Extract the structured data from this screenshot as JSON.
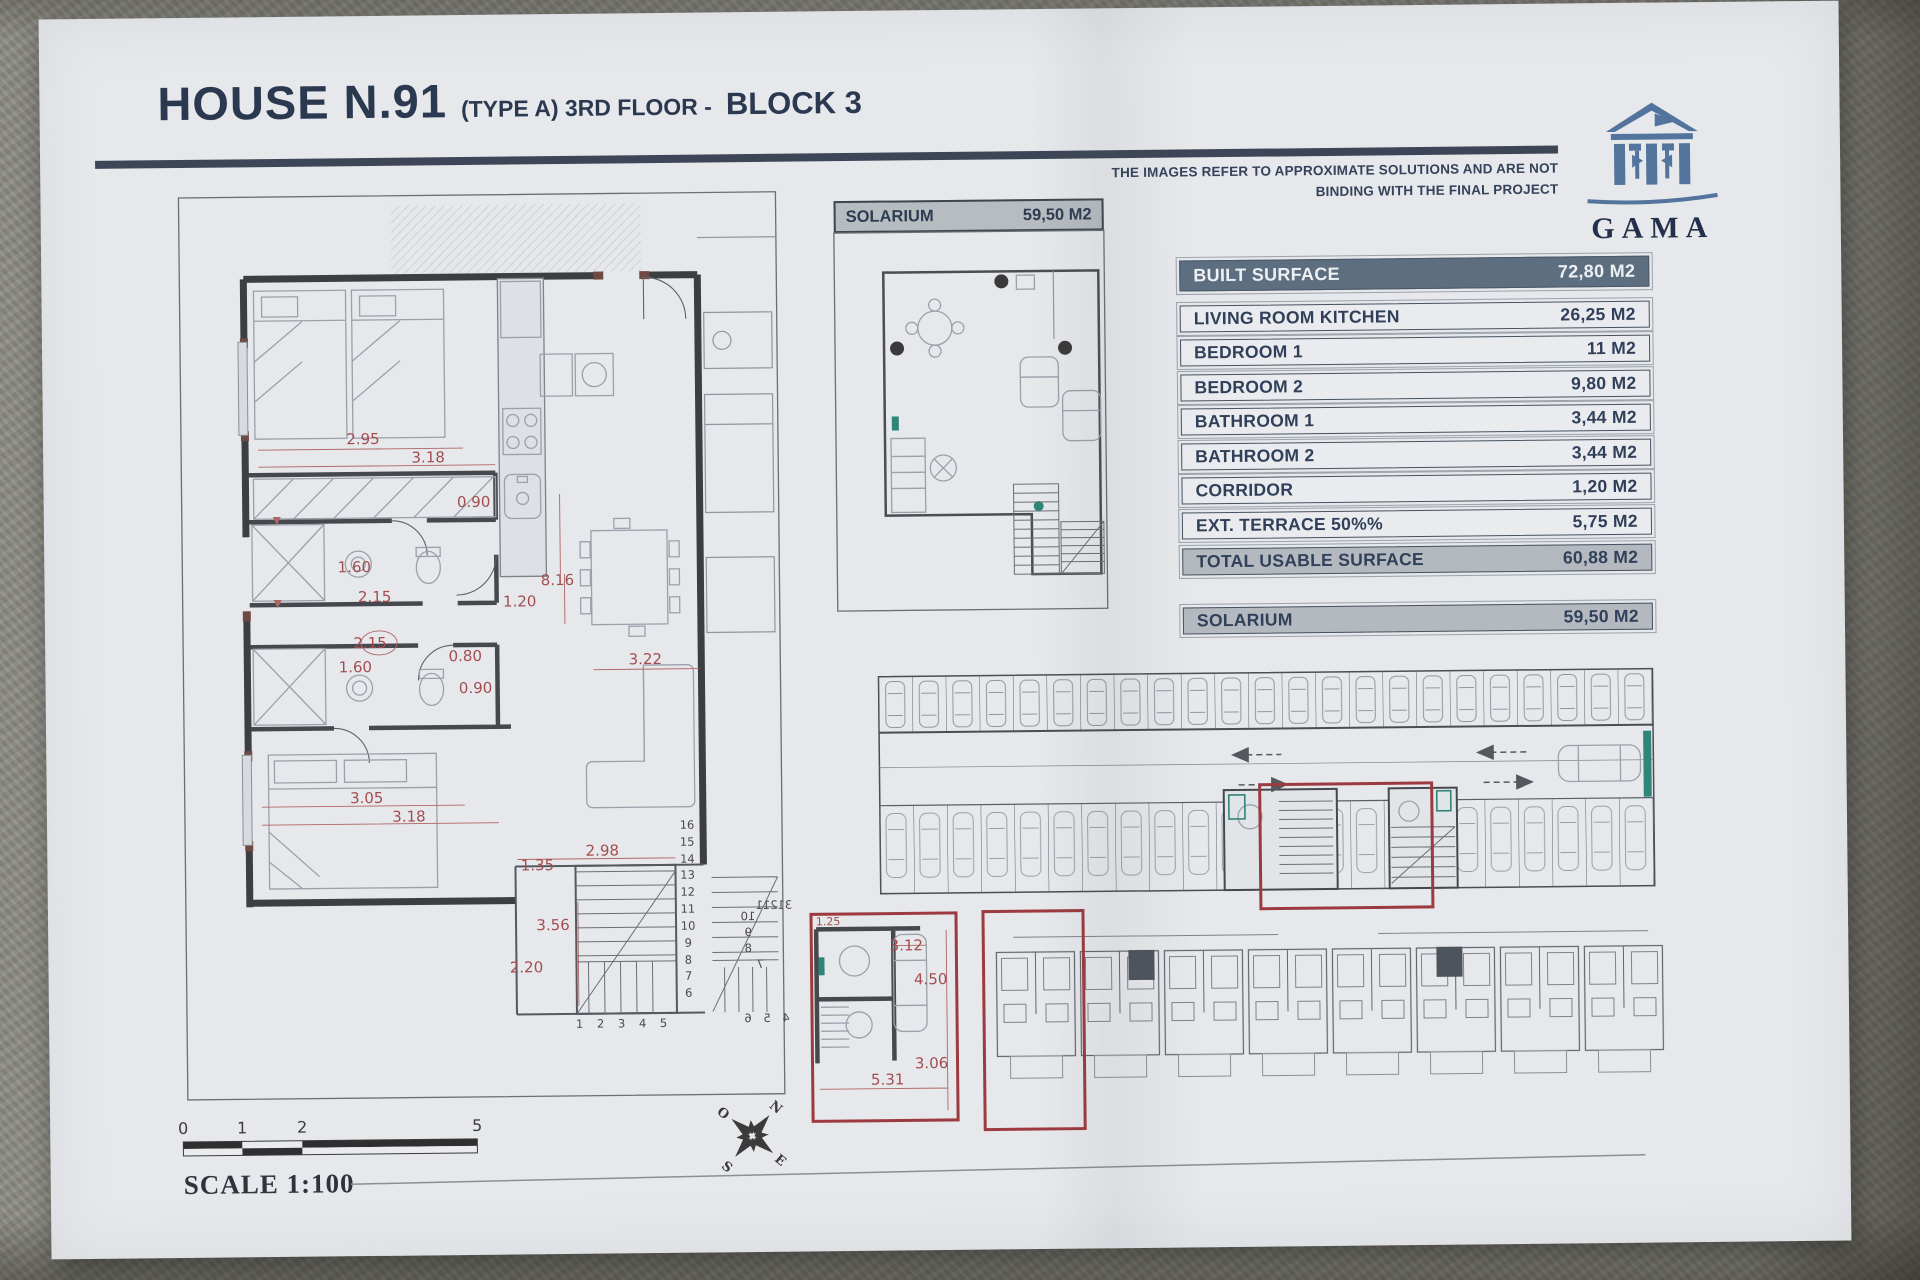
{
  "colors": {
    "accent_navy": "#31405a",
    "table_header_bg": "#5d6e80",
    "highlight_red": "#9c3a40",
    "dimension_red": "#a34d4f",
    "logo_blue": "#53749c",
    "teal_accent": "#2f8577",
    "paper": "#e6e8eb"
  },
  "header": {
    "title": "HOUSE N.91",
    "subtitle": "(TYPE A) 3RD FLOOR -",
    "block": "BLOCK 3",
    "disclaimer_line1": "THE IMAGES REFER TO APPROXIMATE SOLUTIONS AND ARE NOT",
    "disclaimer_line2": "BINDING WITH THE FINAL PROJECT"
  },
  "logo": {
    "name": "GAMA"
  },
  "surface_table": {
    "built": {
      "label": "BUILT SURFACE",
      "value": "72,80 M2"
    },
    "rows": [
      {
        "label": "LIVING ROOM KITCHEN",
        "value": "26,25 M2"
      },
      {
        "label": "BEDROOM 1",
        "value": "11 M2"
      },
      {
        "label": "BEDROOM 2",
        "value": "9,80 M2"
      },
      {
        "label": "BATHROOM 1",
        "value": "3,44 M2"
      },
      {
        "label": "BATHROOM 2",
        "value": "3,44 M2"
      },
      {
        "label": "CORRIDOR",
        "value": "1,20 M2"
      },
      {
        "label": "EXT. TERRACE 50%%",
        "value": "5,75 M2"
      }
    ],
    "total": {
      "label": "TOTAL USABLE SURFACE",
      "value": "60,88 M2"
    },
    "solarium": {
      "label": "SOLARIUM",
      "value": "59,50 M2"
    }
  },
  "solarium_plan": {
    "label": "SOLARIUM",
    "value": "59,50 M2"
  },
  "floor_plan": {
    "dims": {
      "bedroom1_width": "2.95",
      "bedroom1_length": "3.18",
      "kitchen_opening": "0.90",
      "bathroom1_width": "1.60",
      "bathroom1_length": "2.15",
      "bathroom2_length": "2.15",
      "bathroom2_width": "1.60",
      "door_small": "0.80",
      "door_small2": "0.90",
      "living_length": "8.16",
      "corridor_width": "1.20",
      "living_width": "3.22",
      "bedroom2_width": "3.05",
      "bedroom2_length": "3.18",
      "terrace_height": "1.35",
      "terrace_width": "2.98",
      "stair_depth": "3.56",
      "terrace_depth": "2.20"
    },
    "stair_numbers": [
      "16",
      "15",
      "14",
      "13",
      "12",
      "11",
      "10",
      "9",
      "8",
      "7",
      "6"
    ],
    "stair_run": "1 2 3 4 5",
    "neighbor_stair": [
      "10",
      "9",
      "8",
      "7",
      "31211",
      "4 5 6"
    ]
  },
  "detail_plan": {
    "dims": {
      "width_top": "3.12",
      "length": "4.50",
      "depth": "3.06",
      "width_bottom": "5.31",
      "corner": "1.25"
    }
  },
  "scale_bar": {
    "ticks": [
      "0",
      "1",
      "2",
      "5"
    ],
    "label": "SCALE 1:100"
  },
  "compass": {
    "north": "N",
    "south": "S",
    "east": "E",
    "west": "O"
  }
}
